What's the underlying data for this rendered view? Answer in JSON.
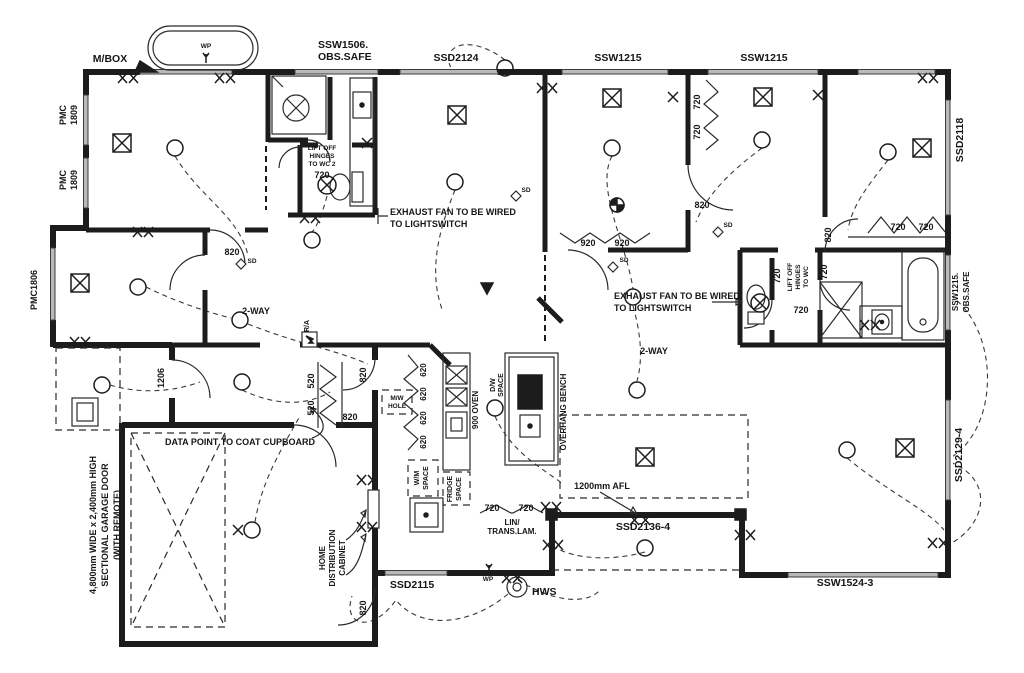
{
  "plan": {
    "window_codes": {
      "mbox": "M/BOX",
      "ssw1506_l1": "SSW1506.",
      "ssw1506_l2": "OBS.SAFE",
      "ssd2124": "SSD2124",
      "ssw1215_top_left": "SSW1215",
      "ssw1215_top_right": "SSW1215",
      "ssd2118": "SSD2118",
      "ssw1215_obs_l1": "SSW1215.",
      "ssw1215_obs_l2": "OBS.SAFE",
      "ssd2129_4": "SSD2129-4",
      "ssw1524_3": "SSW1524-3",
      "ssd2136_4": "SSD2136-4",
      "ssd2115": "SSD2115",
      "pmc": "PMC",
      "pmc_num": "1809",
      "pmc1806": "PMC1806"
    },
    "door_sizes": {
      "d720": "720",
      "d820": "820",
      "d920": "920",
      "d620": "620",
      "d520": "520",
      "d1206": "1206"
    },
    "notes": {
      "exhaust_l1": "EXHAUST FAN TO BE WIRED",
      "exhaust_l2": "TO LIGHTSWITCH",
      "lift_wc2_l1": "LIFT OFF",
      "lift_wc2_l2": "HINGES",
      "lift_wc2_l3": "TO WC 2",
      "lift_wc_l1": "LIFT OFF",
      "lift_wc_l2": "HINGES",
      "lift_wc_l3": "TO WC",
      "data_point": "DATA POINT TO COAT CUPBOARD",
      "afl": "1200mm AFL",
      "two_way": "2-WAY",
      "garage_l1": "4,800mm WIDE x 2,400mm HIGH",
      "garage_l2": "SECTIONAL GARAGE DOOR",
      "garage_l3": "(WITH REMOTE)",
      "hdc_l1": "HOME",
      "hdc_l2": "DISTRIBUTION",
      "hdc_l3": "CABINET",
      "sd": "SD",
      "wp": "WP",
      "hws": "HWS",
      "ra": "R/A"
    },
    "fixtures": {
      "mw_l1": "M/W",
      "mw_l2": "HOLE",
      "oven": "900 OVEN",
      "dw_l1": "D/W",
      "dw_l2": "SPACE",
      "overhang": "OVERHANG BENCH",
      "wm_l1": "W/M",
      "wm_l2": "SPACE",
      "fridge_l1": "FRIDGE",
      "fridge_l2": "SPACE",
      "lin_l1": "LIN/",
      "lin_l2": "TRANS.LAM."
    },
    "symbols": {
      "light": "ceiling light point",
      "double_gpo": "double power point",
      "single_gpo": "single power point",
      "exhaust_fan": "exhaust fan",
      "fan_light": "fan/light unit",
      "smoke_detector": "smoke detector",
      "weatherproof_point": "weatherproof power point",
      "hot_water_system": "hot water system"
    },
    "colors": {
      "ink": "#1c1c1c",
      "paper": "#ffffff",
      "window_fill": "#b9b9b9"
    }
  }
}
